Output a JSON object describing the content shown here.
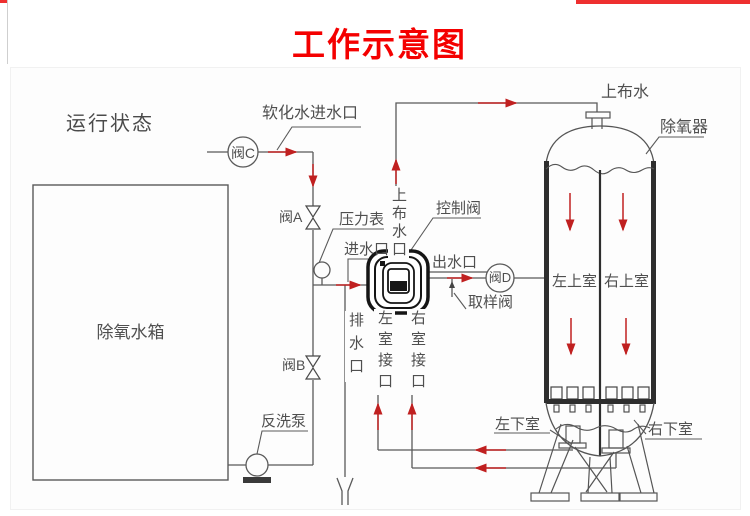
{
  "header": {
    "title": "工作示意图"
  },
  "diagram": {
    "status_label": "运行状态",
    "storage_tank": {
      "label": "除氧水箱"
    },
    "valves": {
      "valve_a": "阀A",
      "valve_b": "阀B",
      "valve_c": "阀C",
      "valve_d": "阀D",
      "control_valve": "控制阀",
      "sampling_valve": "取样阀"
    },
    "instruments": {
      "pressure_gauge": "压力表",
      "backwash_pump": "反洗泵"
    },
    "ports": {
      "softened_water_inlet": "软化水进水口",
      "water_inlet": "进水口",
      "water_outlet": "出水口",
      "drain_outlet": "排水口",
      "upper_distribution_pipe": "上布水口",
      "left_chamber_port": "左室接口",
      "right_chamber_port": "右室接口",
      "upper_distribution": "上布水"
    },
    "deaerator": {
      "label": "除氧器",
      "upper_left_chamber": "左上室",
      "upper_right_chamber": "右上室",
      "lower_left_chamber": "左下室",
      "lower_right_chamber": "右下室"
    },
    "colors": {
      "title_red": "#f40000",
      "arrow_red": "#c02020",
      "line_gray": "#555555"
    }
  }
}
